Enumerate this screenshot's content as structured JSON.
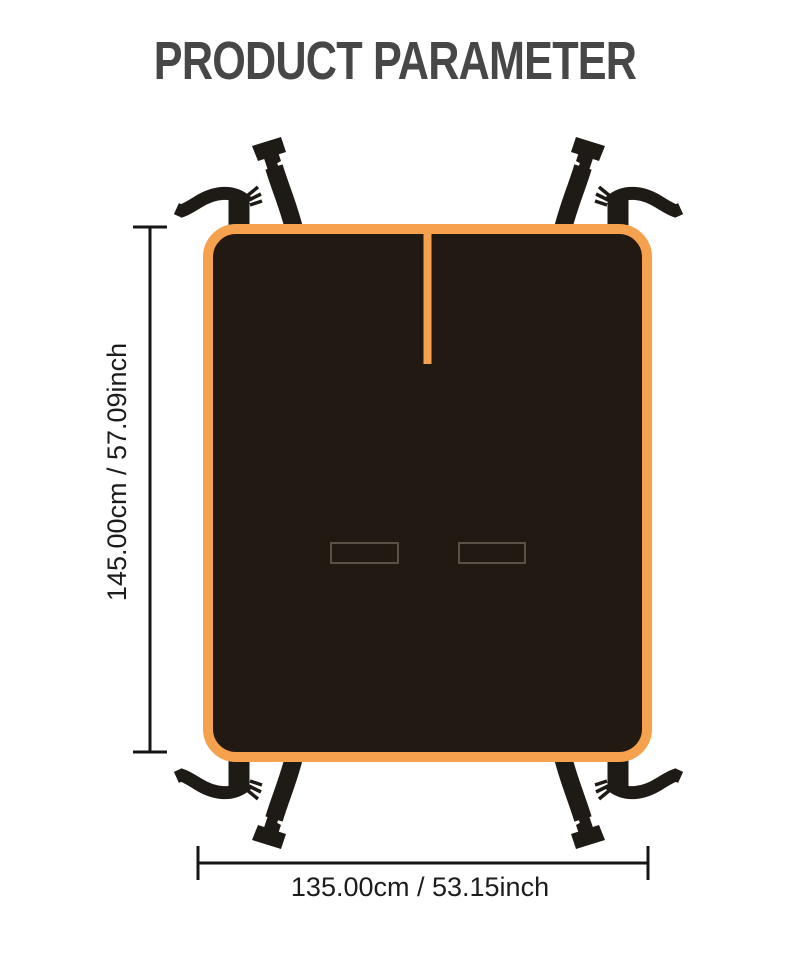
{
  "title": "PRODUCT PARAMETER",
  "diagram": {
    "type": "product-dimensions",
    "height_label": "145.00cm / 57.09inch",
    "width_label": "135.00cm / 53.15inch"
  },
  "colors": {
    "background": "#FFFFFF",
    "accent_orange": "#F5A14E",
    "cover_fill": "#211912",
    "strap_fill": "#1E1A16",
    "slot_outline": "#5A5147",
    "title_text": "#474747",
    "dimension_text": "#1C1C1C",
    "dimension_line": "#161616"
  }
}
